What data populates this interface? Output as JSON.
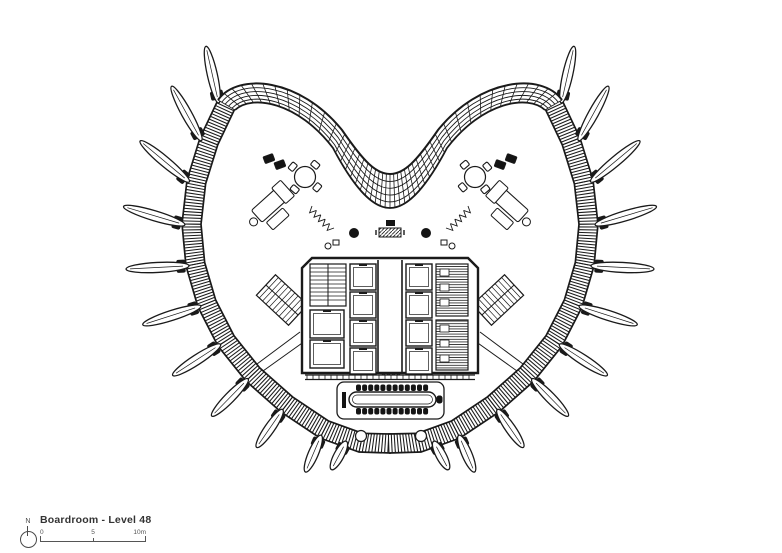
{
  "legend": {
    "north_label": "N",
    "title": "Boardroom - Level 48",
    "scale_start": "0",
    "scale_mid": "5",
    "scale_end": "10m"
  },
  "drawing": {
    "ink_color": "#1a1a1a",
    "paper_color": "#ffffff",
    "furniture_fill": "#141414"
  }
}
